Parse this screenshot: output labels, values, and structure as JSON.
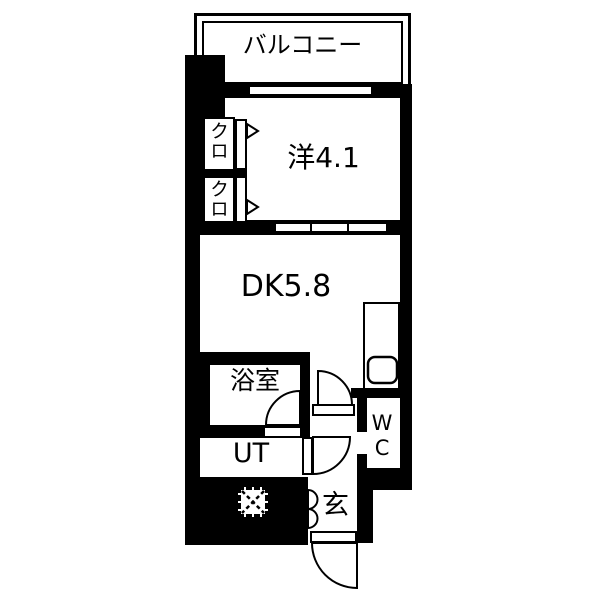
{
  "plan": {
    "type": "apartment-floorplan",
    "colors": {
      "wall": "#000000",
      "floor": "#ffffff",
      "line": "#000000"
    },
    "rooms": {
      "balcony": {
        "label": "バルコニー"
      },
      "western_room": {
        "label": "洋4.1"
      },
      "dining_kitchen": {
        "label": "DK5.8"
      },
      "closet_upper": {
        "label": "クロ"
      },
      "closet_lower": {
        "label": "クロ"
      },
      "bathroom": {
        "label": "浴室"
      },
      "utility": {
        "label": "UT"
      },
      "toilet": {
        "label": "WC"
      },
      "entrance": {
        "label": "玄"
      }
    }
  }
}
